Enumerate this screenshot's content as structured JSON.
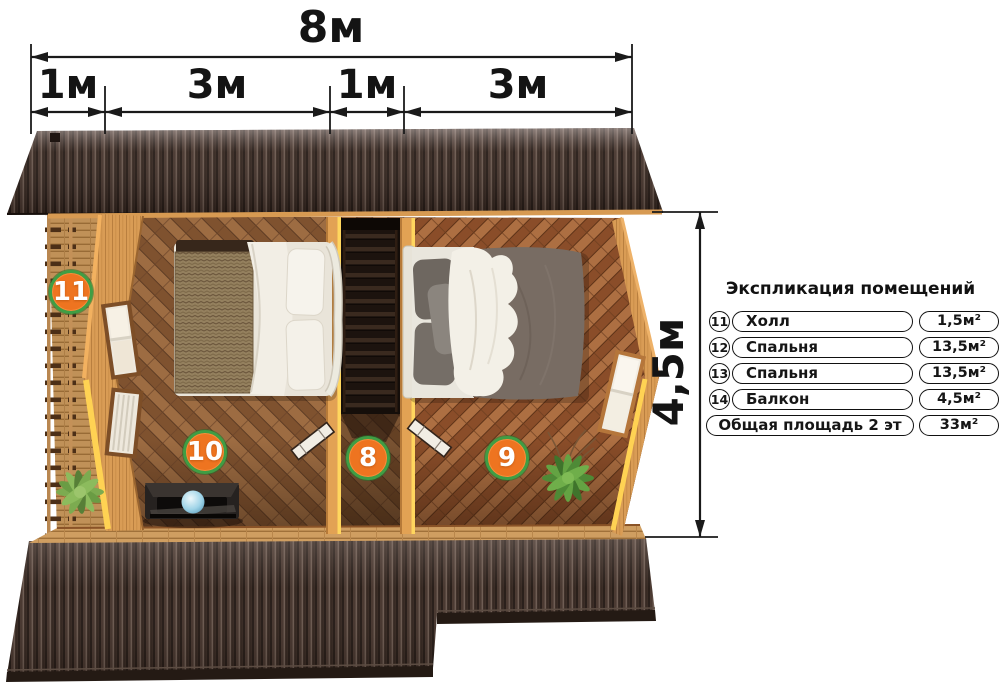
{
  "dimensions": {
    "top_total": "8м",
    "top_segments": [
      "1м",
      "3м",
      "1м",
      "3м"
    ],
    "right_height": "4,5м"
  },
  "markers": [
    {
      "label": "11"
    },
    {
      "label": "10"
    },
    {
      "label": "8"
    },
    {
      "label": "9"
    }
  ],
  "legend": {
    "title": "Экспликация помещений",
    "rows": [
      {
        "num": "11",
        "name": "Холл",
        "area": "1,5м²"
      },
      {
        "num": "12",
        "name": "Спальня",
        "area": "13,5м²"
      },
      {
        "num": "13",
        "name": "Спальня",
        "area": "13,5м²"
      },
      {
        "num": "14",
        "name": "Балкон",
        "area": "4,5м²"
      }
    ],
    "total": {
      "name": "Общая площадь 2 эт",
      "area": "33м²"
    }
  },
  "colors": {
    "marker_fill": "#ee7420",
    "marker_ring": "#3f9e44",
    "roof_dark": "#47362e",
    "wall_wood": "#d99c55",
    "floor_wood": "#905f38",
    "sun_edge": "#ffd253",
    "dimension_line": "#1a1a1a",
    "legend_border": "#111111"
  }
}
